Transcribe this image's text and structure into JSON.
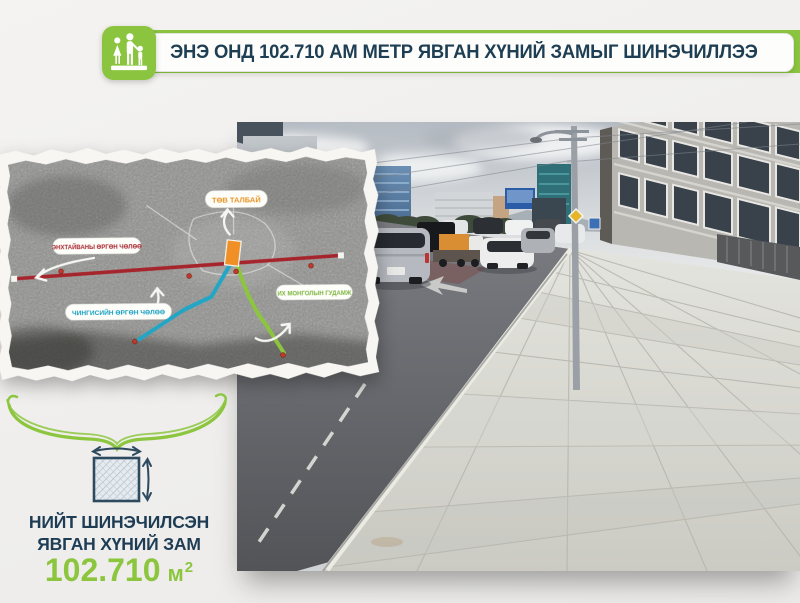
{
  "header": {
    "title": "ЭНЭ ОНД 102.710 АМ МЕТР ЯВГАН ХҮНИЙ ЗАМЫГ ШИНЭЧИЛЛЭЭ",
    "icon": "pedestrian-family-icon"
  },
  "map": {
    "labels": {
      "central_square": {
        "text": "ТӨВ ТАЛБАЙ",
        "color": "#e8941f"
      },
      "peace_avenue": {
        "text": "ЭНХТАЙВАНЫ ӨРГӨН ЧӨЛӨӨ",
        "color": "#a6242b"
      },
      "chinggis_avenue": {
        "text": "ЧИНГИСИЙН ӨРГӨН ЧӨЛӨӨ",
        "color": "#18a2c3"
      },
      "ikh_mongol_street": {
        "text": "ИХ МОНГОЛЫН ГУДАМЖ",
        "color": "#7cb63c"
      }
    }
  },
  "summary": {
    "label_line1": "НИЙТ ШИНЭЧИЛСЭН",
    "label_line2": "ЯВГАН ХҮНИЙ ЗАМ",
    "value": "102.710",
    "unit": "м",
    "unit_exponent": "2"
  },
  "colors": {
    "accent_green": "#8bc53f",
    "navy_text": "#1d3e53",
    "route_red": "#a6242b",
    "route_teal": "#22a6c6",
    "route_green": "#8cc63e",
    "square_orange": "#ef8f25"
  }
}
